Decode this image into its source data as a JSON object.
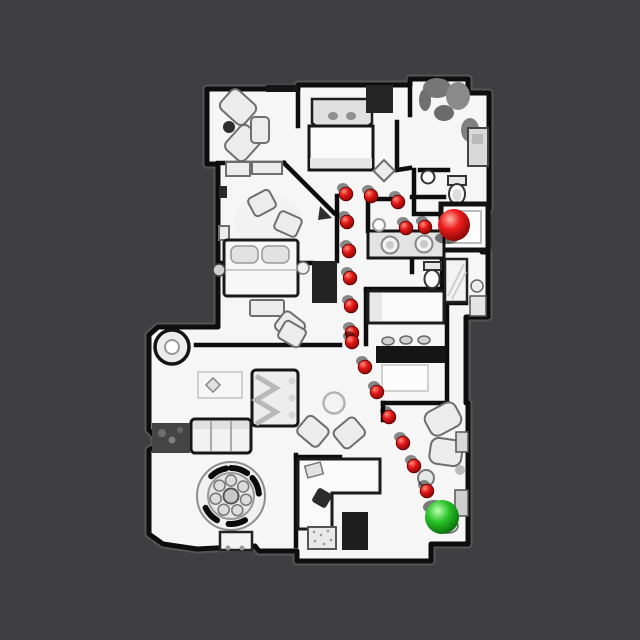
{
  "viewport": {
    "description": "Top-down view of a textured 3D apartment scan with a navigation path of red waypoints from a red start sphere to a green goal sphere",
    "background_color": "#3f3f41",
    "floor_color": "#f6f6f6",
    "wall_color": "#0d0d0d",
    "scan_fringe_color": "#7d7d7d"
  },
  "navigation": {
    "start_marker": {
      "label": "red-sphere-start",
      "color": "#d81616",
      "x": 454,
      "y": 225,
      "radius": 16
    },
    "goal_marker": {
      "label": "green-sphere-goal",
      "color": "#23b523",
      "x": 442,
      "y": 517,
      "radius": 17
    },
    "waypoint_color": "#d01111",
    "waypoint_radius": 6.8,
    "waypoints": [
      [
        425,
        227
      ],
      [
        406,
        228
      ],
      [
        398,
        202
      ],
      [
        371,
        196
      ],
      [
        346,
        194
      ],
      [
        347,
        222
      ],
      [
        349,
        251
      ],
      [
        350,
        278
      ],
      [
        351,
        306
      ],
      [
        352,
        333
      ],
      [
        352,
        342
      ],
      [
        365,
        367
      ],
      [
        377,
        392
      ],
      [
        389,
        417
      ],
      [
        403,
        443
      ],
      [
        414,
        466
      ],
      [
        427,
        491
      ]
    ]
  }
}
